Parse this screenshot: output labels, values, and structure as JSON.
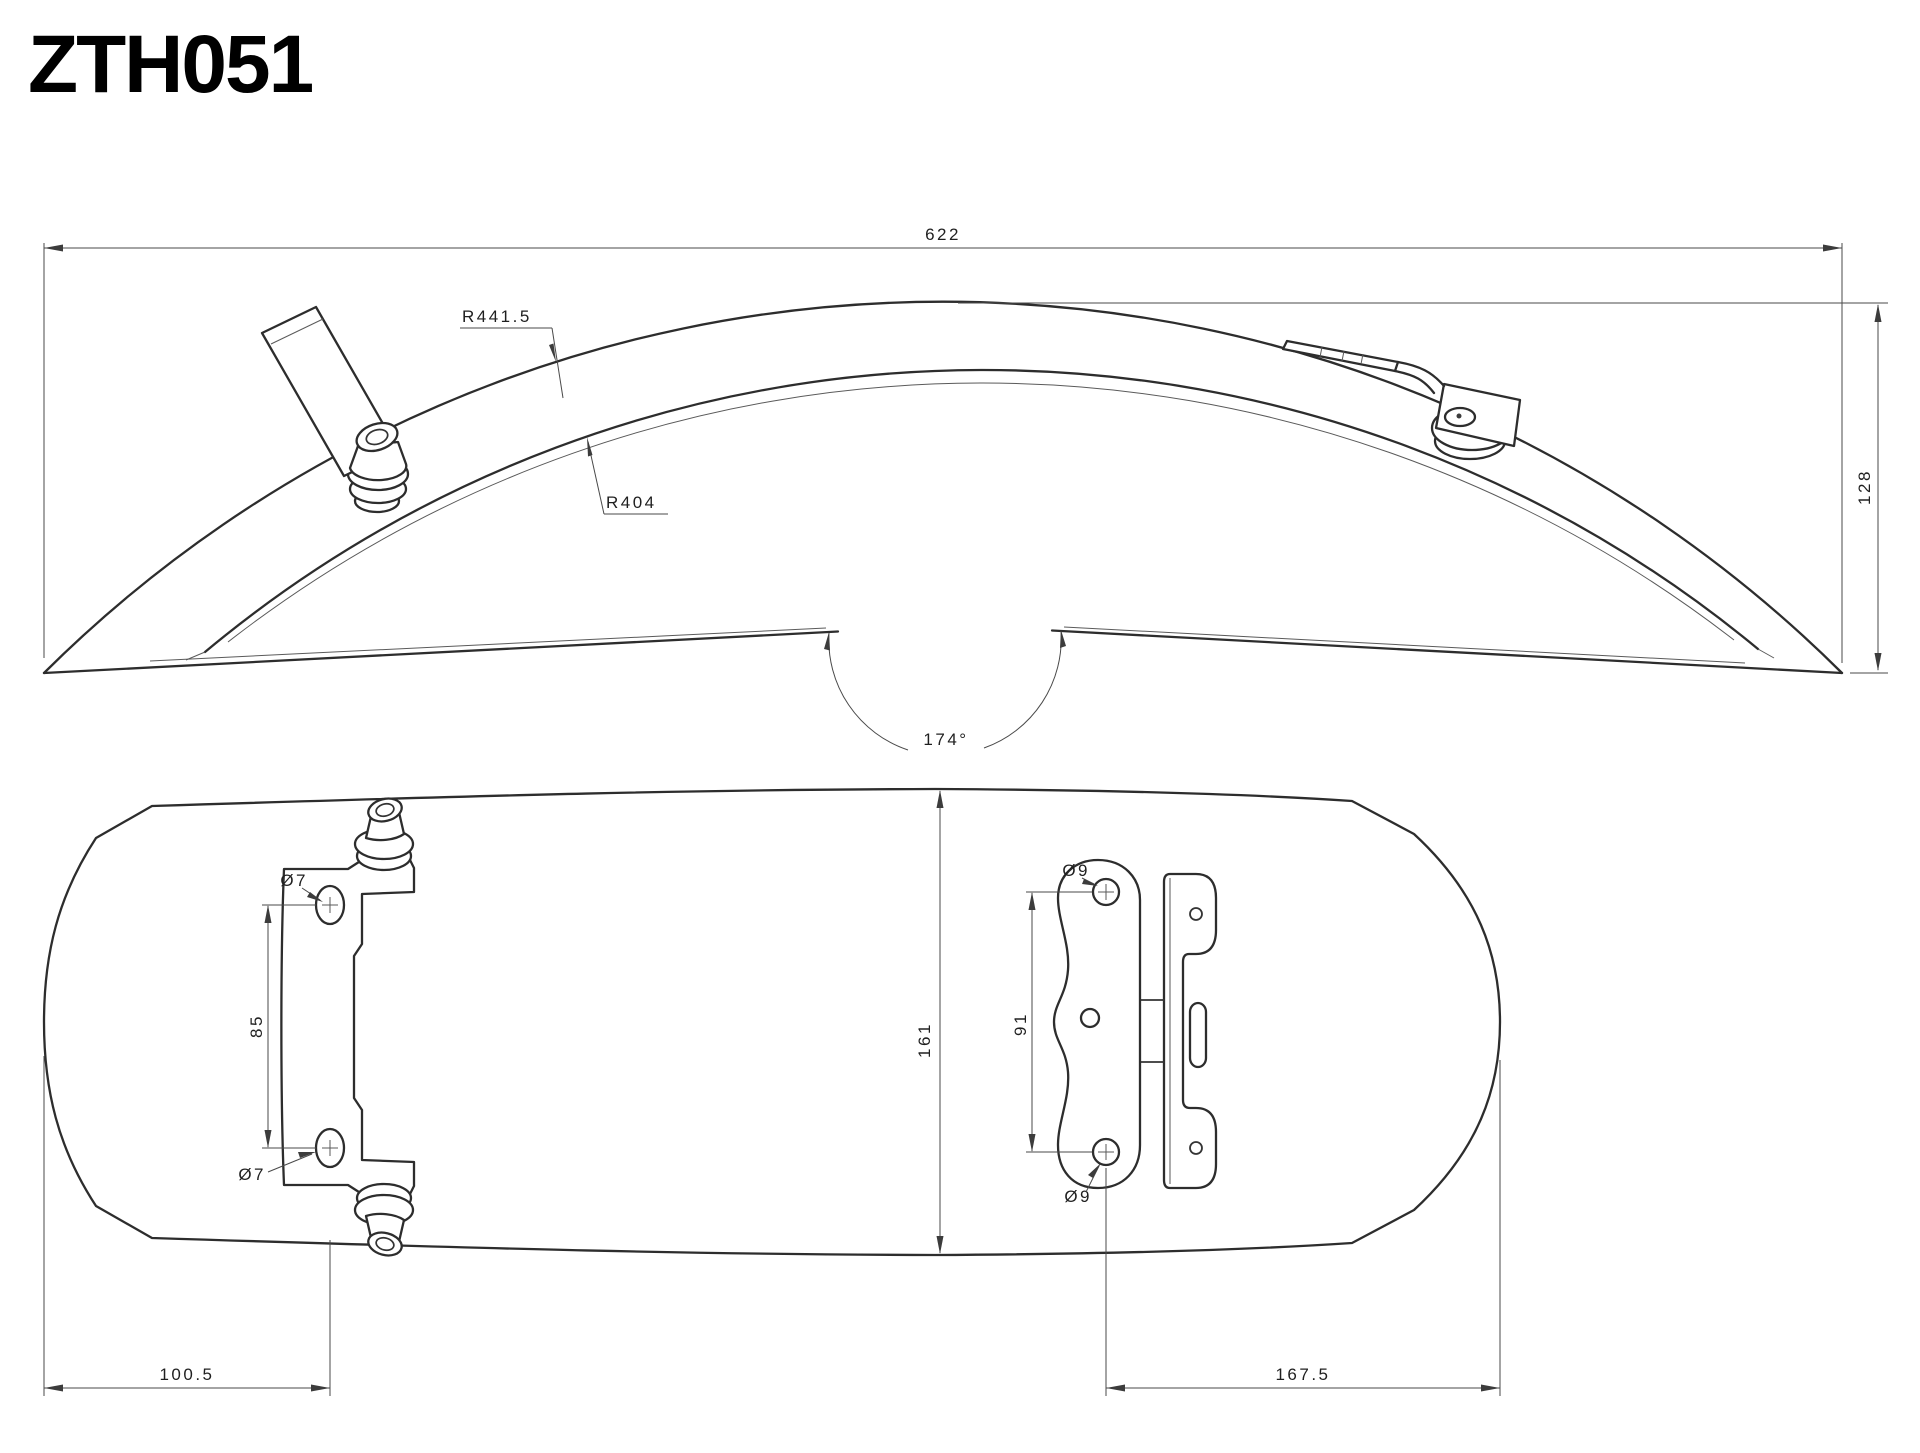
{
  "title": "ZTH051",
  "side_view": {
    "length": "622",
    "outer_radius": "R441.5",
    "inner_radius": "R404",
    "height": "128",
    "bend_angle": "174°"
  },
  "plan_view": {
    "width": "161",
    "left_bracket": {
      "top_hole_dia": "Ø7",
      "bottom_hole_dia": "Ø7",
      "hole_spacing": "85",
      "offset_from_left_edge": "100.5"
    },
    "right_bracket": {
      "top_hole_dia": "Ø9",
      "bottom_hole_dia": "Ø9",
      "hole_spacing": "91",
      "offset_from_right_edge": "167.5"
    }
  }
}
